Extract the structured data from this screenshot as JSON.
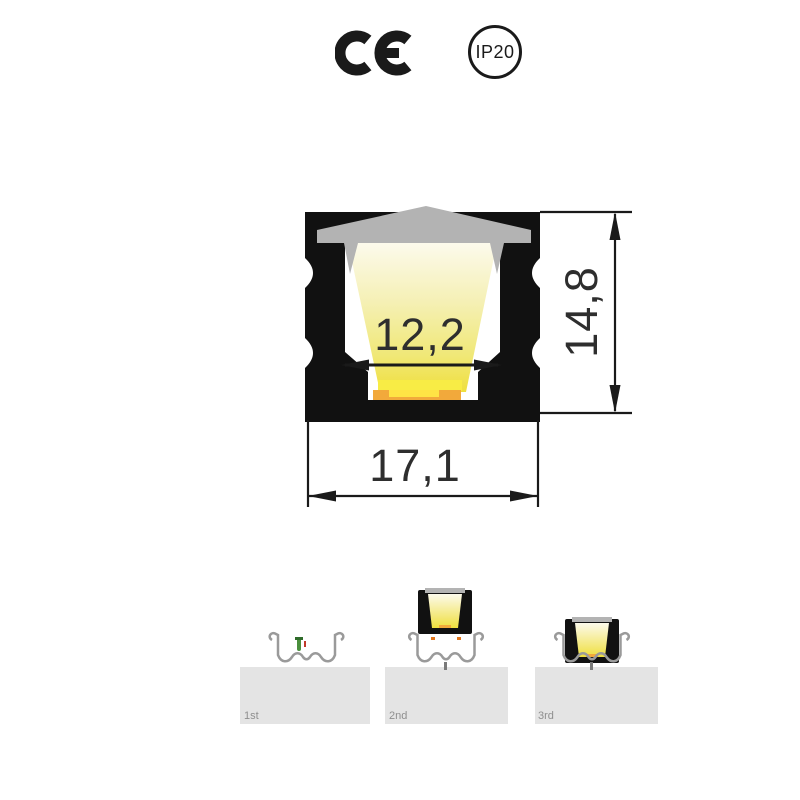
{
  "certifications": {
    "ce_mark": "CE",
    "ip_rating": "IP20"
  },
  "drawing": {
    "type": "led-profile-cross-section",
    "inner_width_mm": "12,2",
    "outer_width_mm": "17,1",
    "height_mm": "14,8"
  },
  "installation": {
    "steps": [
      {
        "label": "1st",
        "description_icon": "mounting-clip-with-screw"
      },
      {
        "label": "2nd",
        "description_icon": "profile-pressed-into-clip"
      },
      {
        "label": "3rd",
        "description_icon": "profile-seated-in-clip"
      }
    ]
  },
  "colors": {
    "profile_body": "#111111",
    "diffuser": "#b3b3b3",
    "glow_top": "#fcfaec",
    "glow_bottom": "#efdf3e",
    "led_strip": "#f2a93b",
    "led_highlight": "#ffe345",
    "press_arrow": "#e2761b",
    "clip_gray": "#9a9a9a",
    "surface": "#e4e4e4",
    "dimension_ink": "#1a1a1a",
    "dimension_text": "#2e2e2e"
  }
}
